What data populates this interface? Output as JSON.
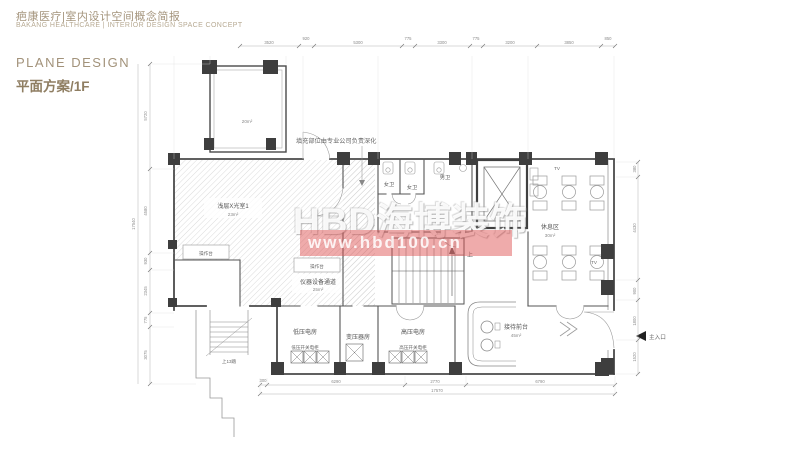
{
  "header": {
    "title_cn": "疤康医疗|室内设计空间概念简报",
    "title_en": "BAKANG HEALTHCARE | INTERIOR DESIGN SPACE CONCEPT",
    "section_en": "PLANE DESIGN",
    "section_cn": "平面方案/1F"
  },
  "watermark": {
    "brand": "HBD海博装饰",
    "url": "www.hbd100.cn",
    "bar_color": "#dd5050"
  },
  "plan": {
    "note": "填充部位由专业公司负责深化",
    "rooms": {
      "tower_area": "20m²",
      "xray": {
        "name": "浅层X光室1",
        "area": "23m²"
      },
      "corridor": {
        "name": "仪器设备通道",
        "area": "25m²"
      },
      "rest": {
        "name": "休息区",
        "area": "30m²"
      },
      "reception": {
        "name": "接待前台",
        "area": "45m²"
      },
      "lv": {
        "name": "低压电房",
        "cabinet": "低压开关电柜"
      },
      "transformer": {
        "name": "变压器房"
      },
      "hv": {
        "name": "高压电房",
        "cabinet": "高压开关电柜"
      },
      "wc_f1": "女卫",
      "wc_f2": "女卫",
      "wc_m": "男卫"
    },
    "labels": {
      "counter1": "操作台",
      "counter2": "操作台",
      "tv1": "TV",
      "tv2": "TV",
      "up": "上",
      "stairs_up": "上13踏",
      "entrance": "主入口"
    },
    "dims": {
      "top": [
        "3520",
        "920",
        "5300",
        "775",
        "3300",
        "775",
        "3200",
        "3850",
        "850"
      ],
      "left": [
        "5720",
        "4580",
        "930",
        "2345",
        "775",
        "3075"
      ],
      "left_total": "17540",
      "bottom": [
        "300",
        "6290",
        "2770",
        "6790"
      ],
      "bottom_total": "17570",
      "right": [
        "380",
        "4430",
        "900",
        "1800",
        "1520"
      ]
    }
  }
}
